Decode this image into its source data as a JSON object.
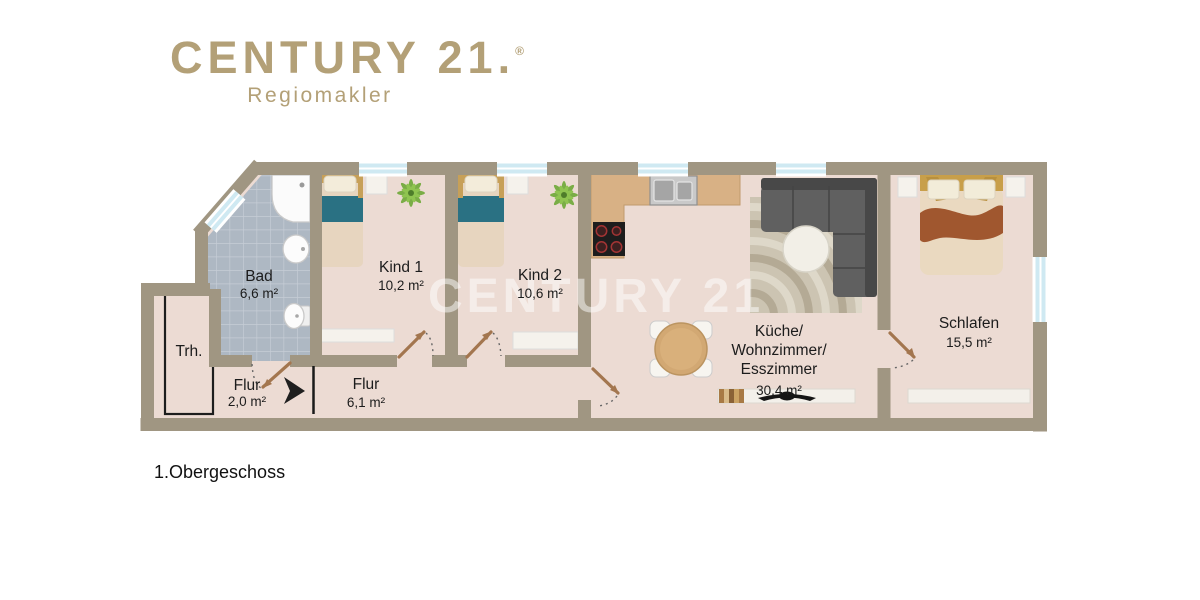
{
  "logo": {
    "brand": "CENTURY 21",
    "period": ".",
    "registered": "®",
    "subtitle": "Regiomakler",
    "brand_color": "#b3a077"
  },
  "watermark": {
    "text": "CENTURY 21"
  },
  "floor_label": "1.Obergeschoss",
  "rooms": [
    {
      "name": "Bad",
      "area": "6,6 m²"
    },
    {
      "name": "Kind 1",
      "area": "10,2 m²"
    },
    {
      "name": "Kind 2",
      "area": "10,6 m²"
    },
    {
      "name": "Küche/Wohnzimmer/Esszimmer",
      "name_lines": [
        "Küche/",
        "Wohnzimmer/",
        "Esszimmer"
      ],
      "area": "30,4 m²"
    },
    {
      "name": "Schlafen",
      "area": "15,5 m²"
    },
    {
      "name": "Trh."
    },
    {
      "name": "Flur",
      "area": "2,0 m²"
    },
    {
      "name": "Flur",
      "area": "6,1 m²"
    }
  ],
  "colors": {
    "wall": "#a09682",
    "floor": "#ecdbd3",
    "bath_tile": "#aeb8c3",
    "kitchen_counter": "#d8b185",
    "bed_blanket_teal": "#2a7183",
    "bed_blanket_rust": "#a0572f",
    "window_glass": "#cfe9f2",
    "sofa_gray": "#5c5c5c"
  }
}
